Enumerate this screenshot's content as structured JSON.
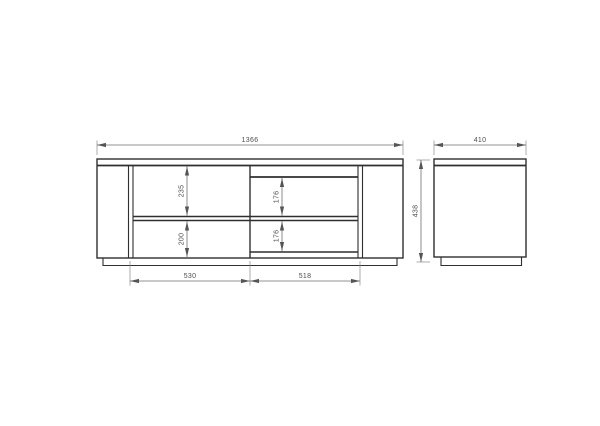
{
  "drawing": {
    "front_view": {
      "overall_width": "1366",
      "overall_height": "438",
      "left_section_upper_height": "235",
      "left_section_lower_height": "200",
      "right_section_upper_height": "176",
      "right_section_lower_height": "176",
      "left_section_width": "530",
      "right_section_width": "518"
    },
    "side_view": {
      "depth": "410"
    },
    "colors": {
      "outline": "#2f2f2f",
      "dimension_line": "#6f6f6f",
      "text": "#4d4d4d",
      "background": "#ffffff"
    }
  }
}
